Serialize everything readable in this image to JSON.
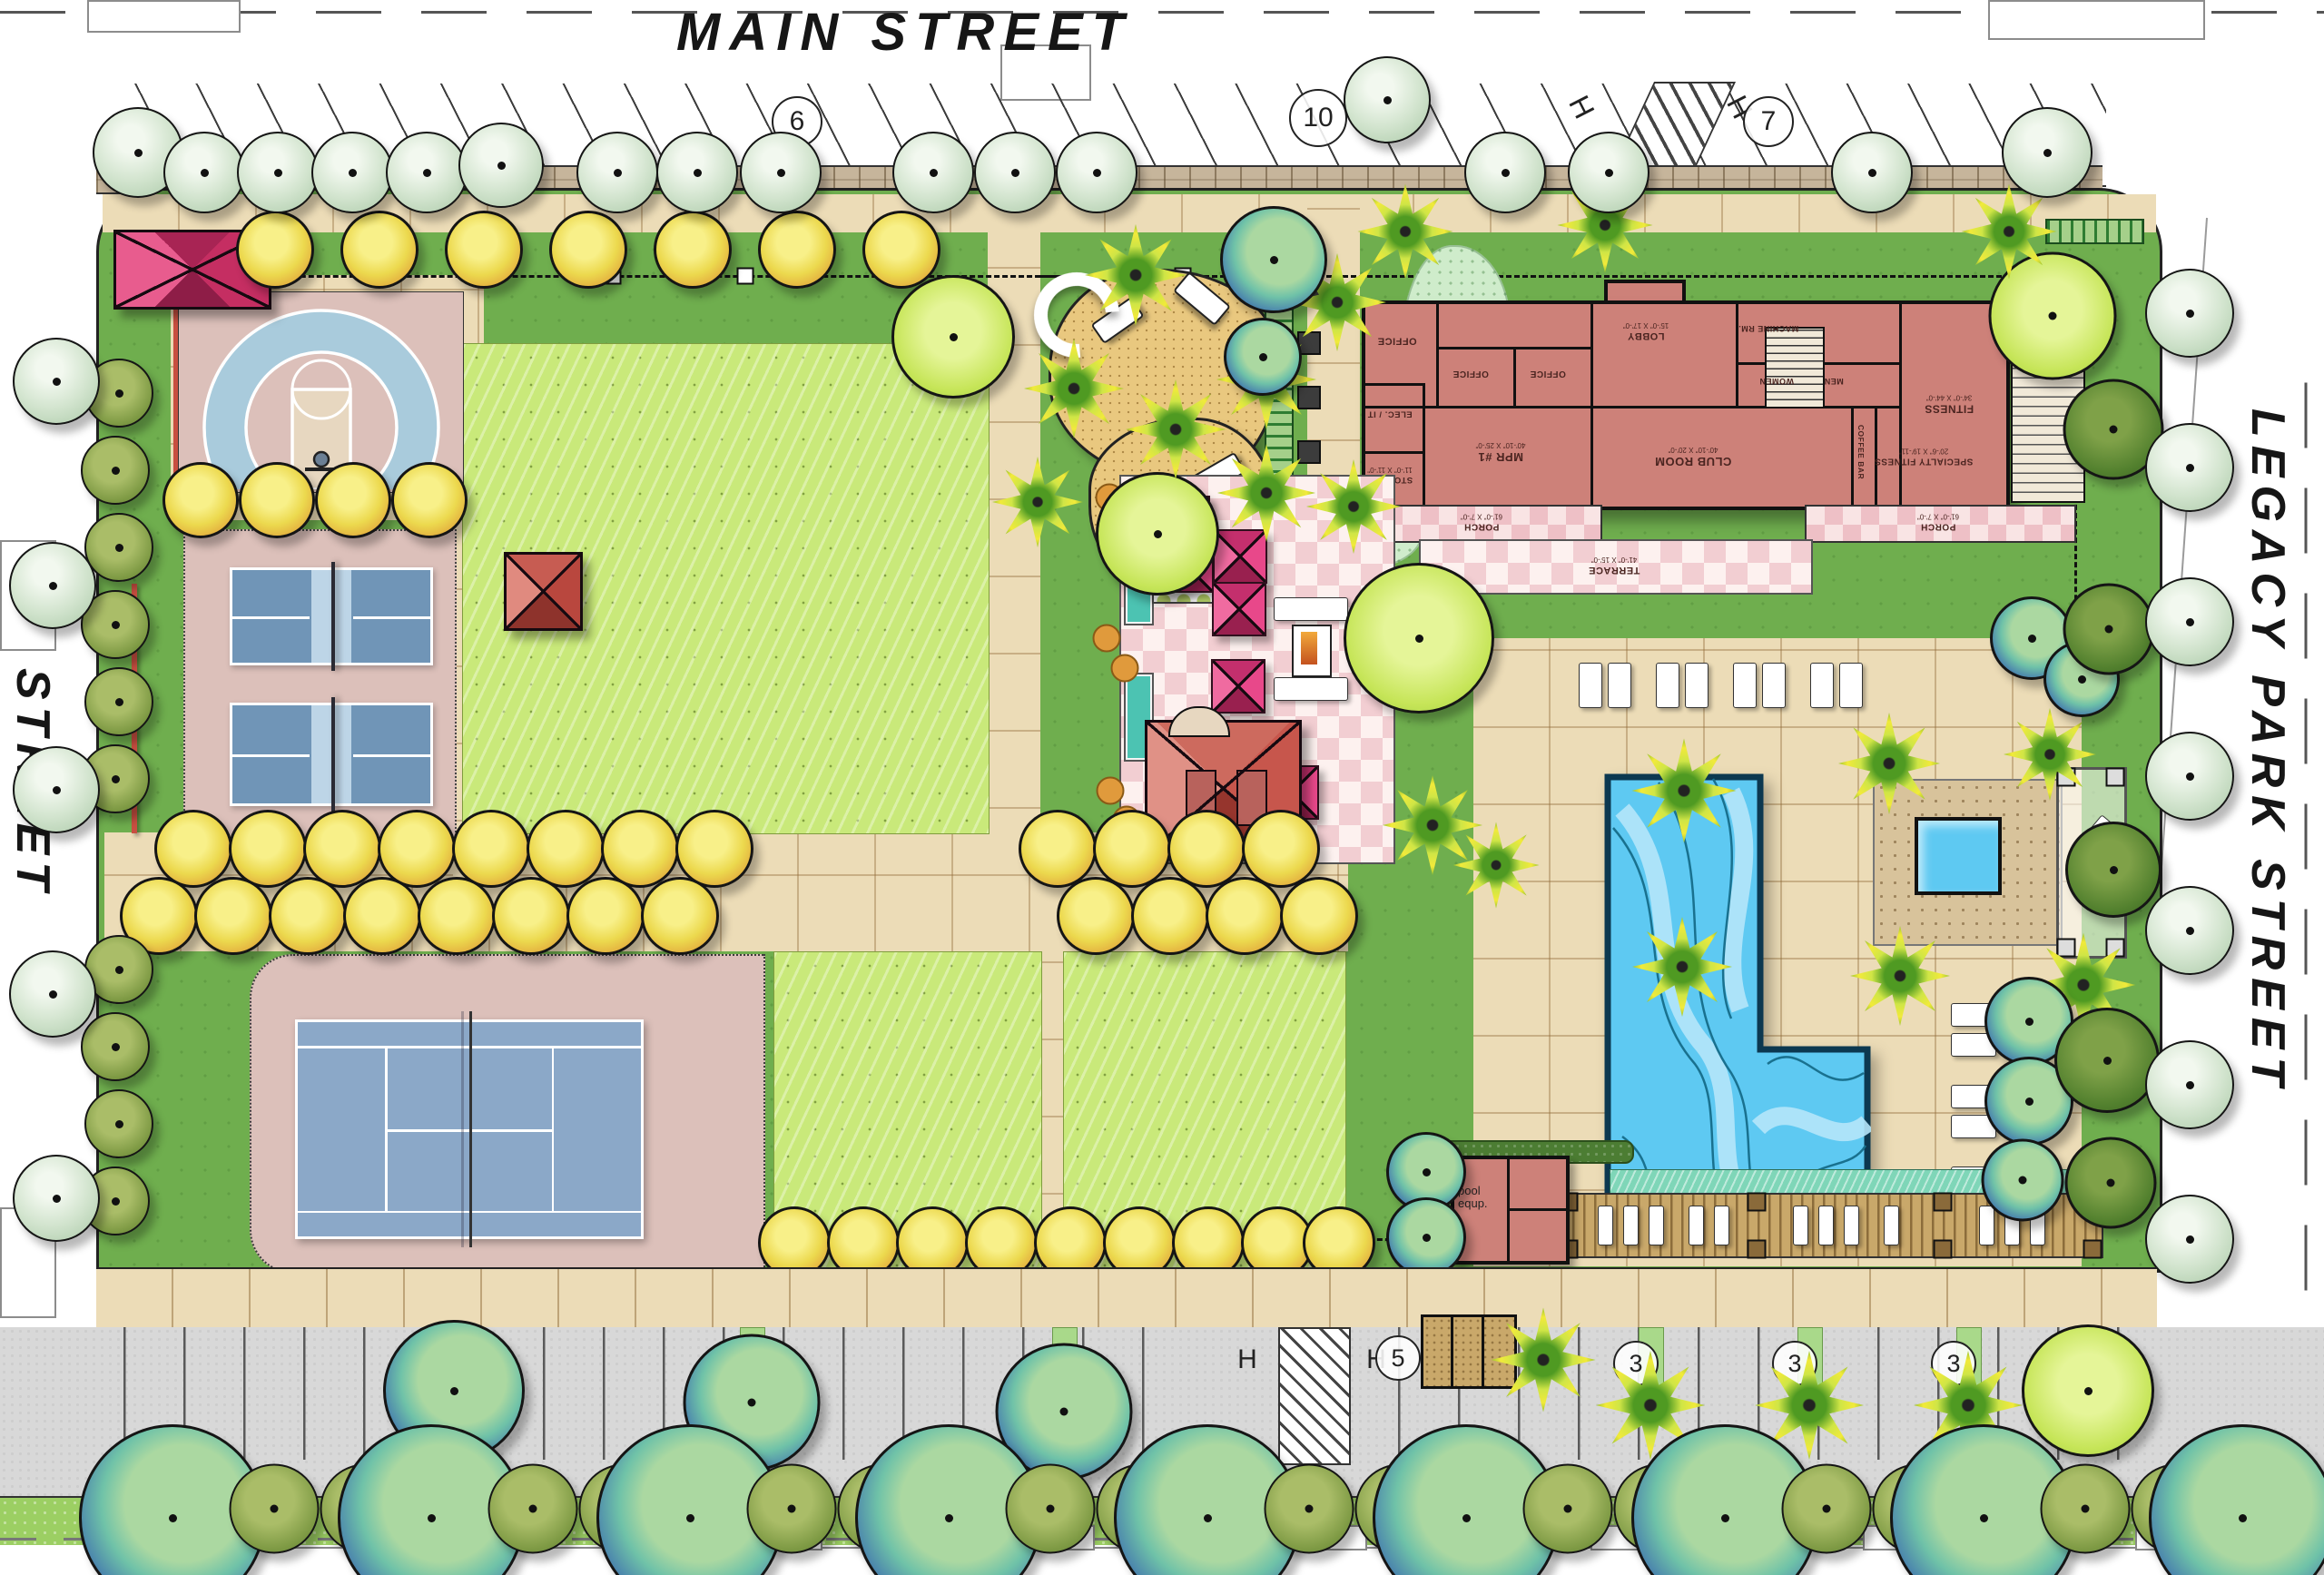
{
  "streets": {
    "top": "MAIN  STREET",
    "left": "“B”  STREET",
    "right": "LEGACY  PARK  STREET"
  },
  "parking": {
    "top": [
      {
        "label": "6"
      },
      {
        "label": "10"
      },
      {
        "label": "H"
      },
      {
        "label": "H"
      },
      {
        "label": "7"
      }
    ],
    "bottom": [
      {
        "label": "6"
      },
      {
        "label": "7"
      },
      {
        "label": "7"
      },
      {
        "label": "H"
      },
      {
        "label": "H"
      },
      {
        "label": "5"
      },
      {
        "label": "3"
      },
      {
        "label": "3"
      },
      {
        "label": "3"
      },
      {
        "label": "2"
      }
    ]
  },
  "building": {
    "rooms": [
      {
        "name": "OFFICE",
        "dim": ""
      },
      {
        "name": "OFFICE",
        "dim": ""
      },
      {
        "name": "OFFICE",
        "dim": ""
      },
      {
        "name": "ELEC. / IT",
        "dim": ""
      },
      {
        "name": "STORAGE",
        "dim": "11'-0\" X 11'-0\""
      },
      {
        "name": "MPR #1",
        "dim": "40'-10\" X 25'-0\""
      },
      {
        "name": "LOBBY",
        "dim": "15'-0\" X 17'-0\""
      },
      {
        "name": "MACHINE RM.",
        "dim": ""
      },
      {
        "name": "WOMEN",
        "dim": ""
      },
      {
        "name": "MEN",
        "dim": ""
      },
      {
        "name": "CLUB ROOM",
        "dim": "40'-10\" X 20'-0\""
      },
      {
        "name": "COFFEE BAR",
        "dim": ""
      },
      {
        "name": "SPECIALTY FITNESS",
        "dim": "20'-6\" X 19'-11\""
      },
      {
        "name": "FITNESS",
        "dim": "34'-0\" X 44'-0\""
      },
      {
        "name": "PORCH",
        "dim": "61'-0\" X 7'-0\""
      },
      {
        "name": "TERRACE",
        "dim": "41'-0\" X 15'-0\""
      },
      {
        "name": "PORCH",
        "dim": "61'-0\" X 7'-0\""
      }
    ]
  },
  "misc": {
    "pool_equipment": "pool equp."
  },
  "colors": {
    "turf": "#6fae4e",
    "lawn": "#c9e97a",
    "paving": "#ecdcb7",
    "pool_water": "#5ec9f2",
    "court_blue": "#8ba8c8",
    "court_surround": "#dcc0ba",
    "building_fill": "#cd8179",
    "umbrella_pink": "#e8488a",
    "accent_red": "#c84f41"
  }
}
